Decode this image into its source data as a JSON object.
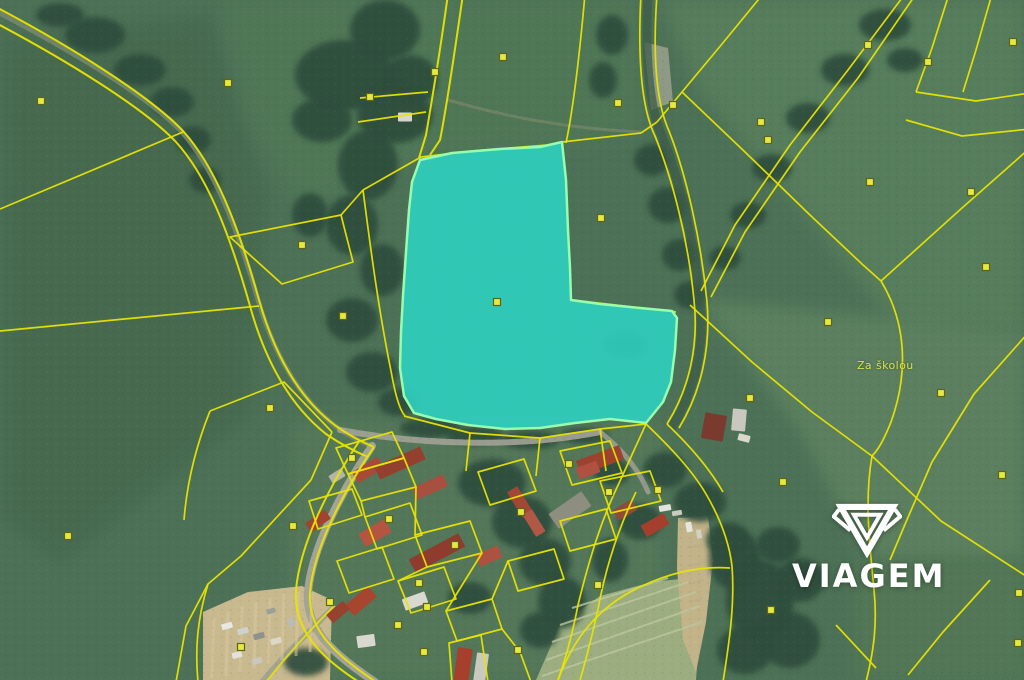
{
  "watermark": {
    "text": "VIAGEM"
  },
  "map": {
    "base_color": "#4d7156",
    "forest_color": "#2f4e3e",
    "boundary_color": "#e8e400",
    "marker_fill": "#e6ea3f",
    "marker_stroke": "#60641a",
    "place_label": {
      "text": "Za školou",
      "x": 860,
      "y": 366
    },
    "highlight_parcel": {
      "fill": "#2ed3c3",
      "fill_opacity": 0.88,
      "stroke": "#97fcae",
      "stroke_width": 2.5,
      "marker": [
        497,
        302
      ],
      "points": [
        [
          420,
          160
        ],
        [
          452,
          153
        ],
        [
          500,
          149
        ],
        [
          540,
          147
        ],
        [
          562,
          142
        ],
        [
          566,
          180
        ],
        [
          568,
          230
        ],
        [
          570,
          268
        ],
        [
          571,
          300
        ],
        [
          600,
          304
        ],
        [
          640,
          308
        ],
        [
          672,
          311
        ],
        [
          677,
          318
        ],
        [
          675,
          350
        ],
        [
          671,
          382
        ],
        [
          663,
          402
        ],
        [
          646,
          423
        ],
        [
          610,
          419
        ],
        [
          575,
          423
        ],
        [
          540,
          428
        ],
        [
          505,
          429
        ],
        [
          468,
          425
        ],
        [
          436,
          419
        ],
        [
          414,
          413
        ],
        [
          404,
          396
        ],
        [
          400,
          368
        ],
        [
          401,
          332
        ],
        [
          403,
          296
        ],
        [
          406,
          252
        ],
        [
          409,
          210
        ],
        [
          412,
          182
        ]
      ]
    },
    "patches": [
      {
        "pts": "0,40 210,14 268,200 248,420 60,566 0,520",
        "fill": "#466b50",
        "blur": 1
      },
      {
        "pts": "220,0 640,0 640,132 560,146 420,159 300,212 248,118",
        "fill": "#507757",
        "blur": 1
      },
      {
        "pts": "660,0 1024,0 1024,330 900,330 760,160 700,92",
        "fill": "#577d5b",
        "blur": 1
      },
      {
        "pts": "700,300 1024,332 1024,560 868,560 800,430",
        "fill": "#5b805f",
        "blur": 1
      },
      {
        "pts": "856,560 1024,560 1024,680 856,680",
        "fill": "#527757",
        "blur": 1
      },
      {
        "pts": "292,420 660,420 660,680 284,680",
        "fill": "#56795a",
        "op": 0.85,
        "blur": 1
      },
      {
        "pts": "536,680 560,625 600,596 652,582 690,578 702,600 696,680",
        "fill": "#9cae80"
      },
      {
        "pts": "203,612 248,592 302,586 332,600 330,680 203,680",
        "fill": "#c9b98f"
      },
      {
        "pts": "678,518 708,516 713,560 706,622 696,672 683,640 677,568",
        "fill": "#c3b389"
      },
      {
        "pts": "644,42 668,48 673,102 651,110",
        "fill": "#9aa18d",
        "op": 0.85
      }
    ],
    "forests": [
      [
        95,
        35,
        30,
        18
      ],
      [
        140,
        70,
        26,
        16
      ],
      [
        172,
        102,
        22,
        15
      ],
      [
        193,
        140,
        18,
        14
      ],
      [
        205,
        180,
        16,
        13
      ],
      [
        60,
        15,
        24,
        12
      ],
      [
        385,
        30,
        35,
        30
      ],
      [
        410,
        80,
        28,
        25
      ],
      [
        345,
        75,
        50,
        35
      ],
      [
        395,
        115,
        38,
        28
      ],
      [
        368,
        165,
        30,
        35
      ],
      [
        352,
        225,
        26,
        30
      ],
      [
        382,
        270,
        22,
        26
      ],
      [
        352,
        320,
        26,
        22
      ],
      [
        372,
        372,
        26,
        20
      ],
      [
        398,
        402,
        20,
        14
      ],
      [
        322,
        120,
        30,
        22
      ],
      [
        310,
        215,
        18,
        22
      ],
      [
        612,
        35,
        16,
        20
      ],
      [
        603,
        80,
        14,
        18
      ],
      [
        652,
        160,
        18,
        16
      ],
      [
        668,
        205,
        20,
        18
      ],
      [
        680,
        255,
        18,
        16
      ],
      [
        690,
        295,
        16,
        14
      ],
      [
        885,
        25,
        26,
        16
      ],
      [
        845,
        70,
        24,
        16
      ],
      [
        808,
        118,
        22,
        15
      ],
      [
        772,
        168,
        20,
        14
      ],
      [
        748,
        215,
        18,
        13
      ],
      [
        725,
        258,
        16,
        12
      ],
      [
        905,
        60,
        18,
        12
      ],
      [
        625,
        345,
        22,
        14
      ],
      [
        430,
        428,
        30,
        10
      ],
      [
        475,
        436,
        28,
        9
      ],
      [
        530,
        440,
        30,
        9
      ],
      [
        585,
        436,
        24,
        8
      ],
      [
        492,
        483,
        34,
        24
      ],
      [
        522,
        522,
        30,
        26
      ],
      [
        545,
        562,
        26,
        24
      ],
      [
        562,
        602,
        24,
        26
      ],
      [
        470,
        598,
        22,
        16
      ],
      [
        610,
        560,
        18,
        22
      ],
      [
        640,
        522,
        22,
        18
      ],
      [
        612,
        472,
        18,
        14
      ],
      [
        665,
        470,
        22,
        18
      ],
      [
        700,
        502,
        26,
        20
      ],
      [
        728,
        540,
        22,
        18
      ],
      [
        735,
        560,
        26,
        30
      ],
      [
        760,
        600,
        34,
        40
      ],
      [
        745,
        650,
        28,
        24
      ],
      [
        790,
        640,
        30,
        28
      ],
      [
        800,
        580,
        24,
        22
      ],
      [
        778,
        545,
        22,
        18
      ],
      [
        306,
        662,
        22,
        14
      ],
      [
        540,
        630,
        20,
        18
      ]
    ],
    "roads": [
      {
        "d": "M-6,10 C 70,50 148,96 182,132 C 212,166 236,222 258,300 C 274,354 300,400 338,428 C 352,438 362,442 372,446",
        "c": "#74876b",
        "w": 5,
        "op": 0.9
      },
      {
        "d": "M648,-6 C 645,50 648,105 662,136 C 679,178 694,238 700,301 C 705,346 695,389 673,426",
        "c": "#3d5c49",
        "w": 9,
        "op": 0.75
      },
      {
        "d": "M372,446 C 340,494 312,548 308,592 C 305,630 335,655 375,682",
        "c": "#a3a396",
        "w": 8,
        "op": 1
      },
      {
        "d": "M340,430 C 420,445 520,448 600,432",
        "c": "#a3a396",
        "w": 6,
        "op": 0.9
      },
      {
        "d": "M333,608 C 310,630 285,655 262,682",
        "c": "#9fa093",
        "w": 6,
        "op": 0.9
      },
      {
        "d": "M448,100 C 500,115 560,128 640,132",
        "c": "#8a9070",
        "w": 3,
        "op": 0.5
      },
      {
        "d": "M600,432 C 625,452 640,472 648,492",
        "c": "#a3a396",
        "w": 5,
        "op": 0.8
      }
    ],
    "furrows": [
      {
        "c": "#bcc69c",
        "w": 2,
        "op": 0.8,
        "lines": [
          "M560,625 L688,582",
          "M552,642 L696,592",
          "M546,660 L700,606",
          "M542,676 L702,622",
          "M572,608 L668,578"
        ]
      },
      {
        "c": "#d8c9a0",
        "w": 3,
        "op": 0.55,
        "lines": [
          "M214,618 L212,678",
          "M228,612 L226,676",
          "M242,606 L240,672",
          "M256,602 L254,668",
          "M270,598 L268,664",
          "M284,594 L282,660",
          "M298,592 L296,656",
          "M312,592 L310,652"
        ]
      },
      {
        "c": "#b5ab85",
        "w": 2,
        "op": 0.5,
        "lines": [
          "M684,530 L702,526",
          "M686,548 L704,544",
          "M688,566 L705,562",
          "M689,584 L704,580",
          "M690,602 L703,598"
        ]
      }
    ],
    "lines": [
      {
        "d": "M-6,6 C 70,46 150,96 183,131 C 214,165 237,221 259,300 C 274,353 298,398 336,426 C 352,437 362,442 374,447",
        "w": 2
      },
      {
        "d": "M-6,22 C 66,60 144,108 176,142 C 206,175 228,228 250,306 C 264,357 288,404 326,434 C 342,445 356,452 368,457",
        "w": 2
      },
      {
        "d": "M0,209 L183,132"
      },
      {
        "d": "M0,331 L259,306"
      },
      {
        "d": "M230,237 L341,215 L353,262 L282,284 Z"
      },
      {
        "d": "M341,215 L363,190"
      },
      {
        "d": "M363,190 L421,157 L472,151 L548,145 L562,142 L641,133"
      },
      {
        "d": "M363,190 C 371,252 379,312 391,371 C 395,393 399,409 405,416"
      },
      {
        "d": "M448,-6 C 441,45 432,100 426,135 L419,158",
        "w": 2
      },
      {
        "d": "M463,-6 C 455,50 447,105 440,140 L430,155",
        "w": 2
      },
      {
        "d": "M360,98 L428,92"
      },
      {
        "d": "M358,122 L426,112"
      },
      {
        "d": "M585,-6 C 580,50 574,105 566,143"
      },
      {
        "d": "M641,-6 C 638,50 640,105 655,136 C 672,178 688,238 694,300 C 699,346 689,389 667,424"
      },
      {
        "d": "M657,-6 C 653,50 655,100 669,131 C 686,174 701,240 707,302 C 711,348 701,392 679,428"
      },
      {
        "d": "M905,-6 L848,70 L790,145 L735,225 L701,291"
      },
      {
        "d": "M916,-6 L858,78 L800,152 L745,232 L711,297"
      },
      {
        "d": "M763,-6 L722,44 L682,92 L657,122"
      },
      {
        "d": "M682,92 L745,152 L810,215 L862,264 L881,281"
      },
      {
        "d": "M1030,148 L962,208 L881,281"
      },
      {
        "d": "M881,281 C 906,322 909,372 891,422 C 881,447 875,453 872,456"
      },
      {
        "d": "M690,305 L752,362 L812,412 L872,456"
      },
      {
        "d": "M872,456 L941,521 L1029,578"
      },
      {
        "d": "M872,456 C 864,502 870,546 874,590 C 878,628 872,658 866,682"
      },
      {
        "d": "M1029,332 L974,394 L932,462 L906,522 L890,560"
      },
      {
        "d": "M990,580 L943,632 L908,675"
      },
      {
        "d": "M836,625 L876,668"
      },
      {
        "d": "M949,-6 L932,48 L916,92"
      },
      {
        "d": "M916,92 L976,101 L1030,93"
      },
      {
        "d": "M992,-6 L976,50 L963,92"
      },
      {
        "d": "M906,120 L962,136 L1030,129"
      },
      {
        "d": "M404,416 L470,433 L540,438 L600,429 L646,424"
      },
      {
        "d": "M572,300 L676,312"
      },
      {
        "d": "M641,133 L657,122"
      },
      {
        "d": "M210,411 L284,382 L332,432"
      },
      {
        "d": "M332,432 L311,480"
      },
      {
        "d": "M311,480 L241,556 L208,584 L186,626 L176,682"
      },
      {
        "d": "M208,584 C 197,620 195,650 198,682"
      },
      {
        "d": "M210,411 C 196,446 187,482 184,520"
      },
      {
        "d": "M374,447 C 342,494 314,548 310,592 C 307,630 336,655 376,682",
        "w": 2
      },
      {
        "d": "M360,440 C 328,488 300,544 296,590 C 293,632 324,660 362,684",
        "w": 2
      },
      {
        "d": "M334,606 C 312,628 288,654 266,682"
      },
      {
        "d": "M646,424 C 670,447 692,470 706,494 C 720,518 729,541 732,566"
      },
      {
        "d": "M667,424 C 690,446 710,469 723,492"
      },
      {
        "d": "M732,566 C 735,605 729,644 723,682"
      },
      {
        "d": "M620,481 C 601,520 589,560 578,605 C 571,641 564,663 557,683"
      },
      {
        "d": "M636,492 C 618,529 606,566 598,609 C 591,641 585,663 579,684"
      },
      {
        "d": "M557,683 C 572,640 598,606 642,586 C 672,572 702,566 730,568"
      },
      {
        "d": "M646,424 L620,481"
      },
      {
        "d": "M336,448 L392,432 L404,458 L348,474 Z"
      },
      {
        "d": "M348,474 L404,458 L416,487 L361,501 Z"
      },
      {
        "d": "M309,501 L352,489 L362,515 L318,529 Z"
      },
      {
        "d": "M365,517 L410,503 L422,535 L377,549 Z"
      },
      {
        "d": "M415,535 L470,521 L482,553 L427,567 Z"
      },
      {
        "d": "M478,472 L524,459 L536,491 L490,505 Z"
      },
      {
        "d": "M560,451 L610,441 L622,473 L572,485 Z"
      },
      {
        "d": "M600,481 L650,471 L661,501 L611,513 Z"
      },
      {
        "d": "M337,561 L382,547 L394,579 L349,593 Z"
      },
      {
        "d": "M398,581 L444,567 L456,599 L411,613 Z"
      },
      {
        "d": "M446,611 L492,599 L502,629 L457,641 Z"
      },
      {
        "d": "M508,561 L554,549 L564,579 L518,591 Z"
      },
      {
        "d": "M560,521 L606,509 L616,539 L570,551 Z"
      },
      {
        "d": "M449,643 L481,635 L488,682 L452,682 Z"
      },
      {
        "d": "M470,433 L466,471"
      },
      {
        "d": "M540,438 L536,476"
      },
      {
        "d": "M600,429 L606,471"
      },
      {
        "d": "M416,487 L415,535"
      },
      {
        "d": "M482,553 L446,611"
      },
      {
        "d": "M361,501 L365,517"
      },
      {
        "d": "M492,599 L508,561"
      },
      {
        "d": "M427,567 L398,581"
      },
      {
        "d": "M502,629 L520,652 L531,682"
      }
    ],
    "buildings": [
      [
        368,
        470,
        30,
        13,
        -32,
        "#a84a38"
      ],
      [
        400,
        463,
        50,
        14,
        -24,
        "#93402f"
      ],
      [
        430,
        487,
        34,
        13,
        -24,
        "#a85040"
      ],
      [
        337,
        476,
        15,
        9,
        -32,
        "#b4b4a9"
      ],
      [
        318,
        521,
        24,
        11,
        -36,
        "#a0432f"
      ],
      [
        375,
        533,
        30,
        15,
        -30,
        "#b55440"
      ],
      [
        437,
        553,
        56,
        15,
        -28,
        "#8f3b2d"
      ],
      [
        489,
        556,
        24,
        13,
        -24,
        "#ad5240"
      ],
      [
        520,
        502,
        30,
        12,
        58,
        "#a24734"
      ],
      [
        534,
        523,
        26,
        11,
        58,
        "#b05846"
      ],
      [
        600,
        460,
        46,
        15,
        -20,
        "#9c4330"
      ],
      [
        588,
        470,
        22,
        12,
        -20,
        "#b05040"
      ],
      [
        570,
        510,
        40,
        18,
        -35,
        "#8d8d80"
      ],
      [
        625,
        510,
        22,
        12,
        -30,
        "#8f4a38"
      ],
      [
        655,
        525,
        26,
        13,
        -30,
        "#a33f2c"
      ],
      [
        361,
        601,
        30,
        14,
        -40,
        "#a8452f"
      ],
      [
        338,
        612,
        22,
        11,
        -40,
        "#97422f"
      ],
      [
        415,
        601,
        24,
        12,
        -20,
        "#d9d9d0"
      ],
      [
        366,
        641,
        18,
        12,
        -8,
        "#d8d8cf"
      ],
      [
        463,
        666,
        15,
        36,
        8,
        "#a63f2c"
      ],
      [
        481,
        668,
        12,
        30,
        8,
        "#c9c9bf"
      ],
      [
        714,
        427,
        22,
        26,
        10,
        "#7a3a2e"
      ],
      [
        739,
        420,
        14,
        22,
        5,
        "#c8c8c0"
      ],
      [
        405,
        117,
        14,
        9,
        0,
        "#d6d6cc"
      ]
    ],
    "vehicles": [
      [
        227,
        626,
        11,
        6,
        -15,
        "#e8e8e2"
      ],
      [
        243,
        631,
        11,
        6,
        -15,
        "#cfd2cc"
      ],
      [
        259,
        636,
        11,
        6,
        -15,
        "#8d938c"
      ],
      [
        276,
        641,
        11,
        6,
        -15,
        "#dcd8c8"
      ],
      [
        291,
        622,
        9,
        6,
        70,
        "#b8bdb6"
      ],
      [
        237,
        655,
        10,
        6,
        -15,
        "#e2e2da"
      ],
      [
        257,
        661,
        10,
        6,
        -15,
        "#c8c8c0"
      ],
      [
        271,
        611,
        9,
        5,
        -15,
        "#99a098"
      ],
      [
        689,
        527,
        10,
        6,
        80,
        "#e6e6de"
      ],
      [
        699,
        534,
        9,
        5,
        80,
        "#d0d0c6"
      ],
      [
        665,
        508,
        12,
        6,
        -10,
        "#e4e4dc"
      ],
      [
        677,
        513,
        10,
        5,
        -10,
        "#cacac0"
      ],
      [
        744,
        438,
        12,
        7,
        15,
        "#dad8cc"
      ]
    ],
    "markers": [
      [
        41,
        101
      ],
      [
        228,
        83
      ],
      [
        302,
        245
      ],
      [
        343,
        316
      ],
      [
        270,
        408
      ],
      [
        68,
        536
      ],
      [
        293,
        526
      ],
      [
        241,
        647
      ],
      [
        601,
        218
      ],
      [
        618,
        103
      ],
      [
        673,
        105
      ],
      [
        761,
        122
      ],
      [
        768,
        140
      ],
      [
        868,
        45
      ],
      [
        928,
        62
      ],
      [
        1013,
        42
      ],
      [
        870,
        182
      ],
      [
        971,
        192
      ],
      [
        986,
        267
      ],
      [
        828,
        322
      ],
      [
        941,
        393
      ],
      [
        1002,
        475
      ],
      [
        783,
        482
      ],
      [
        750,
        398
      ],
      [
        771,
        610
      ],
      [
        1019,
        593
      ],
      [
        1018,
        643
      ],
      [
        419,
        583
      ],
      [
        518,
        650
      ],
      [
        598,
        585
      ],
      [
        330,
        602
      ],
      [
        427,
        607
      ],
      [
        398,
        625
      ],
      [
        424,
        652
      ],
      [
        352,
        458
      ],
      [
        389,
        519
      ],
      [
        455,
        545
      ],
      [
        521,
        512
      ],
      [
        569,
        464
      ],
      [
        609,
        492
      ],
      [
        658,
        490
      ],
      [
        503,
        57
      ],
      [
        435,
        72
      ],
      [
        370,
        97
      ]
    ]
  }
}
